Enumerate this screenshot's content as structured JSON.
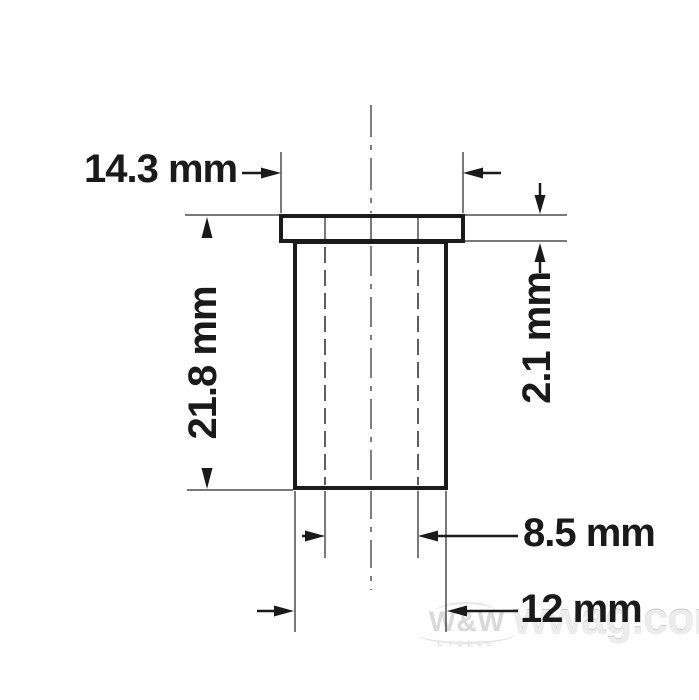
{
  "drawing": {
    "type": "technical-dimension-drawing",
    "part": "flanged sleeve bushing, front section view",
    "colors": {
      "outline": "#1b1b1b",
      "thin_line": "#4d4d4d",
      "dimension_line": "#1a1a1a",
      "text": "#1a1a1a",
      "background": "#ffffff"
    },
    "dimensions": [
      {
        "id": "flange-diameter",
        "label": "14.3 mm"
      },
      {
        "id": "overall-length",
        "label": "21.8 mm"
      },
      {
        "id": "flange-thickness",
        "label": "2.1 mm"
      },
      {
        "id": "inner-diameter",
        "label": "8.5 mm"
      },
      {
        "id": "outer-diameter",
        "label": "12 mm"
      }
    ]
  },
  "watermark": {
    "logo": "W&W",
    "logo_sub": "CYCLES",
    "site": "wwag.com"
  }
}
